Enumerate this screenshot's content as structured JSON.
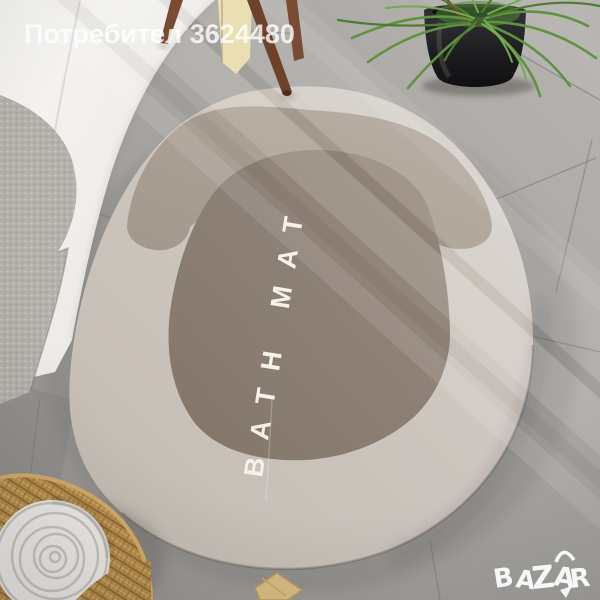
{
  "watermark": {
    "text": "Потребител 3624480"
  },
  "mat": {
    "label": "BATH MAT"
  },
  "logo": {
    "letters": [
      "B",
      "A",
      "Z",
      "A",
      "R"
    ]
  },
  "colors": {
    "floor": "#a5a3a0",
    "tub": "#f3f2f0",
    "tub_towel": "#b5b0aa",
    "mat_outer": "#cdc6bf",
    "mat_band": "#a89d92",
    "mat_center": "#8d8076",
    "mat_label": "#f6f2ea",
    "stool_leg": "#7a4b33",
    "hanging_towel": "#eadfb2",
    "pot": "#1e1d20",
    "leaves": "#5f9340",
    "basket": "#b8904e",
    "rolled_towel": "#ecebe7",
    "gold_decor": "#d8bc83",
    "watermark": "#ffffff",
    "logo": "#ffffff"
  }
}
